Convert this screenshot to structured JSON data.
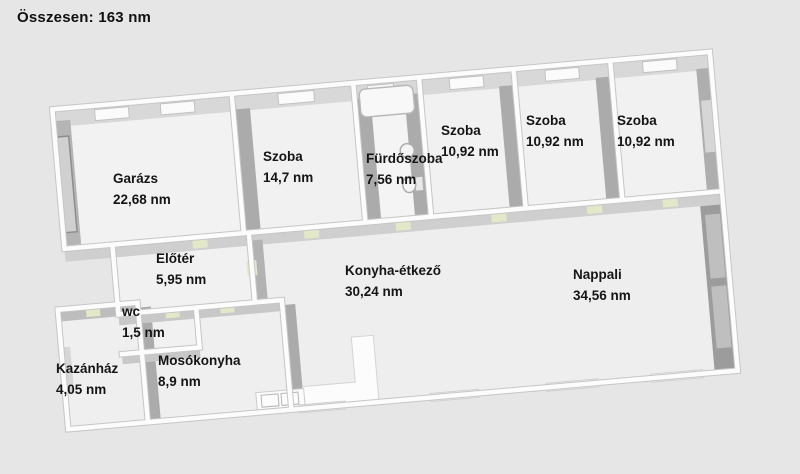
{
  "title": "Összesen: 163 nm",
  "unit": "nm",
  "rooms": [
    {
      "id": "garazs",
      "name": "Garázs",
      "area": "22,68 nm"
    },
    {
      "id": "szoba-1",
      "name": "Szoba",
      "area": "14,7 nm"
    },
    {
      "id": "furdoszoba",
      "name": "Fürdőszoba",
      "area": "7,56 nm"
    },
    {
      "id": "szoba-2",
      "name": "Szoba",
      "area": "10,92 nm"
    },
    {
      "id": "szoba-3",
      "name": "Szoba",
      "area": "10,92 nm"
    },
    {
      "id": "szoba-4",
      "name": "Szoba",
      "area": "10,92 nm"
    },
    {
      "id": "eloter",
      "name": "Előtér",
      "area": "5,95 nm"
    },
    {
      "id": "konyha-etkezo",
      "name": "Konyha-étkező",
      "area": "30,24 nm"
    },
    {
      "id": "nappali",
      "name": "Nappali",
      "area": "34,56 nm"
    },
    {
      "id": "wc",
      "name": "wc",
      "area": "1,5 nm"
    },
    {
      "id": "mosokonyha",
      "name": "Mosókonyha",
      "area": "8,9 nm"
    },
    {
      "id": "kazanhaz",
      "name": "Kazánház",
      "area": "4,05 nm"
    }
  ],
  "colors": {
    "background": "#e6e6e6",
    "wall_top": "#fcfcfc",
    "wall_face_dark": "#a9a9a9",
    "wall_face_light": "#d6d6d6",
    "floor": "#f1f1f1",
    "door_accent": "#e3e8c8",
    "text": "#151515"
  }
}
